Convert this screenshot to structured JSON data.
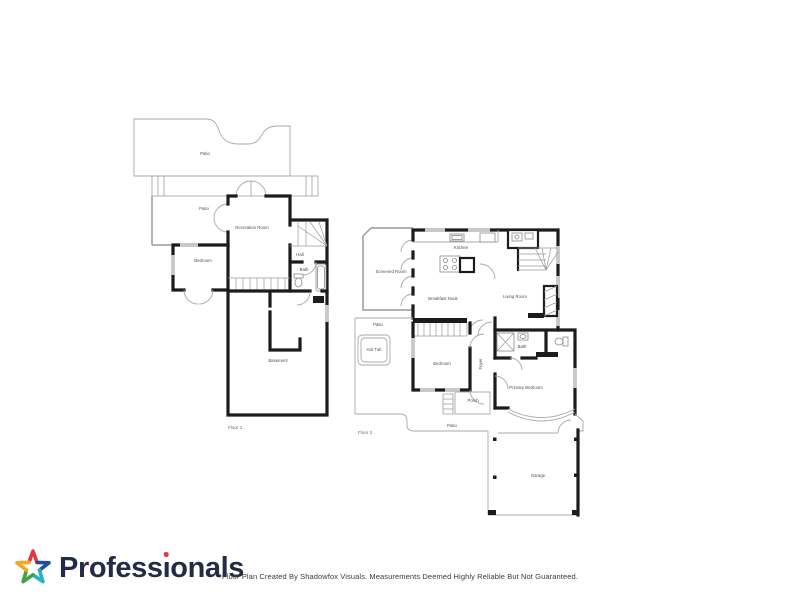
{
  "colors": {
    "wall": "#1c1c1c",
    "thin": "#a8a8a8",
    "label": "#4f4f4f",
    "window": "#c9c9c9",
    "brand-text": "#232c47",
    "star-red": "#e03a3f",
    "star-blue": "#1f4e9c",
    "star-teal": "#29b0c7",
    "star-green": "#43a047",
    "star-orange": "#f5a81c",
    "disclaimer": "#3a3a3a"
  },
  "floor1": {
    "caption": "Floor 1",
    "rooms": {
      "patio_upper": "Patio",
      "patio_small": "Patio",
      "recreation": "Recreation Room",
      "bedroom": "Bedroom",
      "hall": "Hall",
      "bath": "Bath",
      "basement": "Basement"
    }
  },
  "floor2": {
    "caption": "Floor 2",
    "rooms": {
      "screened": "Screened Room",
      "kitchen": "Kitchen",
      "breakfast": "Breakfast Nook",
      "living": "Living Room",
      "patio_upper": "Patio",
      "hot_tub": "Hot Tub",
      "bedroom": "Bedroom",
      "foyer": "Foyer",
      "bath": "Bath",
      "primary": "Primary Bedroom",
      "porch": "Porch",
      "patio_lower": "Patio",
      "garage": "Garage"
    }
  },
  "footer": {
    "brand": "Professionals",
    "brand_part1": "Profess",
    "brand_i": "ı",
    "brand_part2": "onals",
    "disclaimer": "Floor Plan Created By Shadowfox Visuals. Measurements Deemed Highly Reliable But Not Guaranteed."
  }
}
